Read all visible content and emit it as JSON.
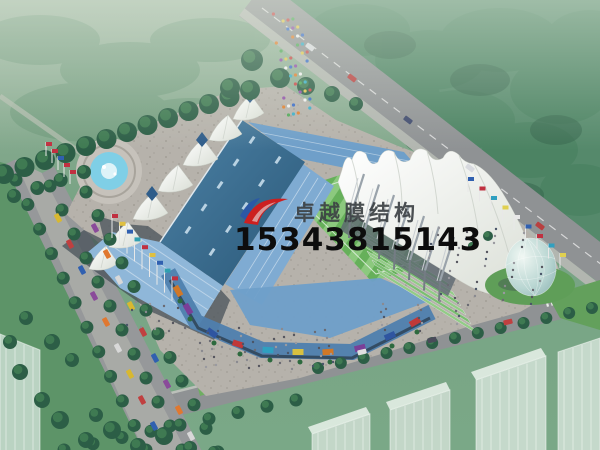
{
  "image": {
    "description": "aerial architectural rendering of a stadium with white tensile membrane roofs",
    "watermark": {
      "company_name": "卓越膜结构",
      "phone_number": "15343815143",
      "logo": "red-blue-swoosh-logo"
    },
    "palette": {
      "membrane_white": "#f2f3ef",
      "roof_blue": "#36678c",
      "stands_blue": "#7fabd2",
      "pitch_green": "#66b05a",
      "pitch_green_light": "#8cc97e",
      "forest_green": "#4a8062",
      "lawn_green": "#7da487",
      "plaza_gray": "#b6b2ab",
      "road_gray": "#8f9294",
      "water_blue": "#7fcfe6",
      "logo_red": "#cc2020",
      "logo_blue": "#2a56a8"
    }
  }
}
